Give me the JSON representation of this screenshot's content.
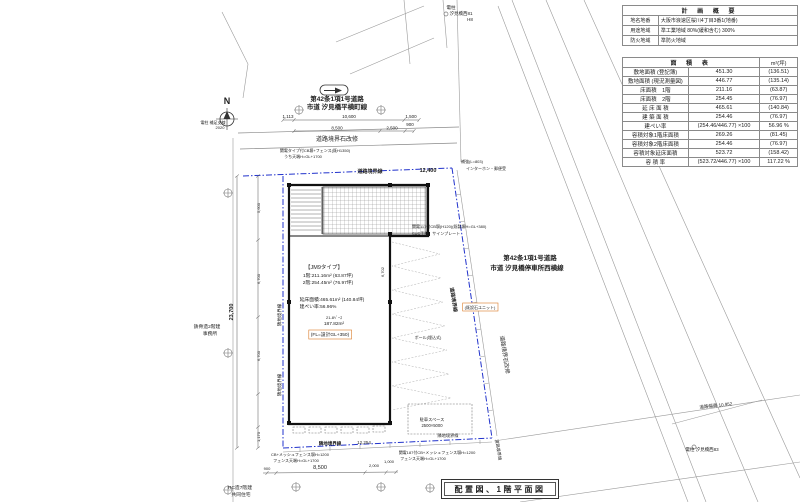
{
  "title_box": {
    "text": "配置図、1階平面図"
  },
  "plan_table": {
    "title": "計 画 概 要",
    "rows": [
      {
        "label": "地名地番",
        "value": "大阪市浪速区桜川4丁目3番1(地番)"
      },
      {
        "label": "用途地域",
        "value": "準工業地域 80%(緩和含む) 300%"
      },
      {
        "label": "防火地域",
        "value": "準防火地域"
      }
    ]
  },
  "area_table": {
    "title": "面 積 表",
    "unit": "m²(坪)",
    "rows": [
      {
        "label": "敷地面積 (登記簿)",
        "value": "451.30",
        "tsubo": "(136.51)"
      },
      {
        "label": "敷地面積 (現況測量図)",
        "value": "446.77",
        "tsubo": "(135.14)"
      },
      {
        "label": "床面積　1階",
        "value": "211.16",
        "tsubo": "(63.87)"
      },
      {
        "label": "床面積　2階",
        "value": "254.45",
        "tsubo": "(76.97)"
      },
      {
        "label": "延 床 面 積",
        "value": "465.61",
        "tsubo": "(140.84)"
      },
      {
        "label": "建 築 面 積",
        "value": "254.46",
        "tsubo": "(76.97)"
      },
      {
        "label": "建ぺい率",
        "value": "(254.46/446.77) ×100",
        "tsubo": "56.96 %"
      },
      {
        "label": "容積対象1階床面積",
        "value": "269.26",
        "tsubo": "(81.45)"
      },
      {
        "label": "容積対象2階床面積",
        "value": "254.46",
        "tsubo": "(76.97)"
      },
      {
        "label": "容積対象延床面積",
        "value": "523.72",
        "tsubo": "(158.42)"
      },
      {
        "label": "容 積 率",
        "value": "(523.72/446.77) ×100",
        "tsubo": "117.22 %"
      }
    ]
  },
  "drawing": {
    "colors": {
      "boundary_blue": "#2233cc",
      "note_orange": "#d97b29",
      "wall_black": "#111111",
      "line_gray": "#888888"
    },
    "labels": [
      {
        "t": "N",
        "x": 227,
        "y": 104,
        "s": 9,
        "b": 1,
        "n": "north-label"
      },
      {
        "t": "電柱 補足支線",
        "x": 213,
        "y": 124,
        "s": 4,
        "n": "pole-note"
      },
      {
        "t": "2020",
        "x": 220,
        "y": 129,
        "s": 4,
        "n": "pole-note"
      },
      {
        "t": "電柱",
        "x": 451,
        "y": 9,
        "s": 4.5,
        "n": "pole-note"
      },
      {
        "t": "汐見橋西81",
        "x": 461,
        "y": 15,
        "s": 4.5,
        "n": "pole-note"
      },
      {
        "t": "H8",
        "x": 470,
        "y": 21,
        "s": 4.5,
        "n": "pole-note"
      },
      {
        "t": "マンホール",
        "x": 658,
        "y": 120,
        "s": 4.5,
        "n": "manhole-label"
      },
      {
        "t": "第42条1項1号道路",
        "x": 337,
        "y": 101,
        "s": 6.5,
        "b": 1,
        "n": "road-name-north"
      },
      {
        "t": "市道 汐見橋平横町線",
        "x": 337,
        "y": 109,
        "s": 6.5,
        "b": 1,
        "n": "road-name-north"
      },
      {
        "t": "1,113",
        "x": 288,
        "y": 118,
        "s": 4.5,
        "n": "dim"
      },
      {
        "t": "10,600",
        "x": 349,
        "y": 118,
        "s": 4.5,
        "n": "dim"
      },
      {
        "t": "1,500",
        "x": 411,
        "y": 118,
        "s": 4.5,
        "n": "dim"
      },
      {
        "t": "8,500",
        "x": 337,
        "y": 129.5,
        "s": 4.5,
        "n": "dim"
      },
      {
        "t": "2,500",
        "x": 392,
        "y": 129.5,
        "s": 4.5,
        "n": "dim"
      },
      {
        "t": "900",
        "x": 410,
        "y": 126,
        "s": 4.5,
        "n": "dim"
      },
      {
        "t": "道路境界石改修",
        "x": 337,
        "y": 141,
        "s": 6,
        "n": "curb-repair-label"
      },
      {
        "t": "関電タイプ付CB塀+フェンス(既H1350)",
        "x": 315,
        "y": 152,
        "s": 4,
        "n": "fence-note"
      },
      {
        "t": "うち天端H=GL+1700",
        "x": 303,
        "y": 158,
        "s": 4,
        "n": "fence-note"
      },
      {
        "t": "道路境界線",
        "x": 370,
        "y": 173,
        "s": 5,
        "c": "#2233cc",
        "b": 1,
        "n": "road-boundary-label"
      },
      {
        "t": "12,400",
        "x": 428,
        "y": 172,
        "s": 5.5,
        "c": "#2233cc",
        "b": 1,
        "n": "dim"
      },
      {
        "t": "補強(L=803)",
        "x": 472,
        "y": 163,
        "s": 4,
        "n": "note"
      },
      {
        "t": "インターホン・郵便受",
        "x": 486,
        "y": 170,
        "s": 4,
        "n": "note"
      },
      {
        "t": "関電117付CB塀(H120)(既製塀H=GL+380)",
        "x": 412,
        "y": 228,
        "s": 4,
        "a": "start",
        "n": "fence-note"
      },
      {
        "t": "SUS手摺、サインプレート",
        "x": 412,
        "y": 235,
        "s": 4,
        "a": "start",
        "n": "note"
      },
      {
        "t": "第42条1項1号道路",
        "x": 530,
        "y": 260,
        "s": 6.5,
        "b": 1,
        "n": "road-name-east"
      },
      {
        "t": "市道 汐見橋停車所西横線",
        "x": 527,
        "y": 270,
        "s": 6.5,
        "b": 1,
        "n": "road-name-east"
      },
      {
        "t": "道路境界線",
        "x": 452,
        "y": 300,
        "s": 5,
        "c": "#2233cc",
        "b": 1,
        "r": 81,
        "n": "road-boundary-label"
      },
      {
        "t": "道路境界石改修",
        "x": 503,
        "y": 355,
        "s": 5.5,
        "r": 81,
        "n": "curb-repair-label"
      },
      {
        "t": "(既設石ユニット)",
        "x": 480,
        "y": 309,
        "s": 4,
        "c": "#d97b29",
        "box": 1,
        "n": "note-box"
      },
      {
        "t": "ポール(埋込式)",
        "x": 428,
        "y": 339,
        "s": 4,
        "n": "note"
      },
      {
        "t": "道路幅員 10.952",
        "x": 716,
        "y": 407,
        "s": 4.5,
        "r": -6,
        "n": "road-width-label"
      },
      {
        "t": "電柱 汐見橋西83",
        "x": 702,
        "y": 451,
        "s": 4.5,
        "n": "pole-note"
      },
      {
        "t": "【JM9タイプ】",
        "x": 324,
        "y": 269,
        "s": 5.5,
        "n": "building-type-label"
      },
      {
        "t": "1階:211.16m² (63.87坪)",
        "x": 328,
        "y": 277,
        "s": 4.8,
        "n": "building-area-note"
      },
      {
        "t": "2階:254.45m² (76.97坪)",
        "x": 328,
        "y": 284,
        "s": 4.8,
        "n": "building-area-note"
      },
      {
        "t": "延床面積:465.61m² (140.84坪)",
        "x": 332,
        "y": 301,
        "s": 4.8,
        "n": "building-area-note"
      },
      {
        "t": "建ぺい率:56.96%",
        "x": 318,
        "y": 308,
        "s": 4.8,
        "n": "building-area-note"
      },
      {
        "t": "21-8ﾍﾞｰｽ",
        "x": 334,
        "y": 319,
        "s": 4,
        "n": "note"
      },
      {
        "t": "187.82m²",
        "x": 334,
        "y": 325,
        "s": 4.8,
        "n": "note"
      },
      {
        "t": "(FL=設計GL+350)",
        "x": 330,
        "y": 336,
        "s": 4.8,
        "c": "#d97b29",
        "box": 1,
        "n": "note-box"
      },
      {
        "t": "6,702",
        "x": 384,
        "y": 272,
        "s": 4,
        "r": -90,
        "n": "dim"
      },
      {
        "t": "鉄骨造2階建",
        "x": 207,
        "y": 328,
        "s": 4.8,
        "n": "neighbor-building-label"
      },
      {
        "t": "事務所",
        "x": 210,
        "y": 335,
        "s": 4.8,
        "n": "neighbor-building-label"
      },
      {
        "t": "23,700",
        "x": 233,
        "y": 312,
        "s": 5.5,
        "b": 1,
        "r": -90,
        "n": "dim"
      },
      {
        "t": "5,600",
        "x": 260,
        "y": 208,
        "s": 4,
        "r": -90,
        "n": "dim"
      },
      {
        "t": "6,700",
        "x": 260,
        "y": 279,
        "s": 4,
        "r": -90,
        "n": "dim"
      },
      {
        "t": "6,700",
        "x": 260,
        "y": 356,
        "s": 4,
        "r": -90,
        "n": "dim"
      },
      {
        "t": "1,170",
        "x": 260,
        "y": 437,
        "s": 4,
        "r": -90,
        "n": "dim"
      },
      {
        "t": "隣地境界線",
        "x": 281,
        "y": 315,
        "s": 4.5,
        "c": "#2233cc",
        "r": -90,
        "n": "site-boundary-label"
      },
      {
        "t": "隣地境界線",
        "x": 281,
        "y": 385,
        "s": 4.5,
        "c": "#2233cc",
        "r": -90,
        "n": "site-boundary-label"
      },
      {
        "t": "駐車スペース",
        "x": 432,
        "y": 421,
        "s": 4.2,
        "n": "parking-label"
      },
      {
        "t": "2500×5000",
        "x": 432,
        "y": 427,
        "s": 4.2,
        "n": "parking-label"
      },
      {
        "t": "隣地境界線",
        "x": 330,
        "y": 445,
        "s": 4.5,
        "c": "#2233cc",
        "b": 1,
        "n": "site-boundary-label"
      },
      {
        "t": "12,254",
        "x": 364,
        "y": 444,
        "s": 4.5,
        "c": "#2233cc",
        "n": "dim"
      },
      {
        "t": "隣地境界線",
        "x": 448,
        "y": 437,
        "s": 4.2,
        "c": "#2233cc",
        "n": "site-boundary-label"
      },
      {
        "t": "道路境界線",
        "x": 497,
        "y": 450,
        "s": 4.2,
        "c": "#2233cc",
        "r": 81,
        "n": "road-boundary-label"
      },
      {
        "t": "CB+メッシュフェンス塀H=1200",
        "x": 300,
        "y": 456,
        "s": 4,
        "n": "fence-note"
      },
      {
        "t": "フェンス天端H=GL+1700",
        "x": 296,
        "y": 462,
        "s": 4,
        "n": "fence-note"
      },
      {
        "t": "関電187付CB+メッシュフェンス塀H=1200",
        "x": 437,
        "y": 454,
        "s": 4,
        "n": "fence-note"
      },
      {
        "t": "フェンス天端H=GL+1700",
        "x": 423,
        "y": 460,
        "s": 4,
        "n": "fence-note"
      },
      {
        "t": "900",
        "x": 267,
        "y": 470,
        "s": 4,
        "n": "dim"
      },
      {
        "t": "8,500",
        "x": 320,
        "y": 469,
        "s": 5.5,
        "n": "dim"
      },
      {
        "t": "2,000",
        "x": 374,
        "y": 467,
        "s": 4,
        "n": "dim"
      },
      {
        "t": "1,000",
        "x": 389,
        "y": 463,
        "s": 4,
        "n": "dim"
      },
      {
        "t": "RC造7階建",
        "x": 240,
        "y": 489,
        "s": 4.8,
        "n": "neighbor-building-label"
      },
      {
        "t": "共同住宅",
        "x": 241,
        "y": 496,
        "s": 4.8,
        "n": "neighbor-building-label"
      }
    ]
  }
}
